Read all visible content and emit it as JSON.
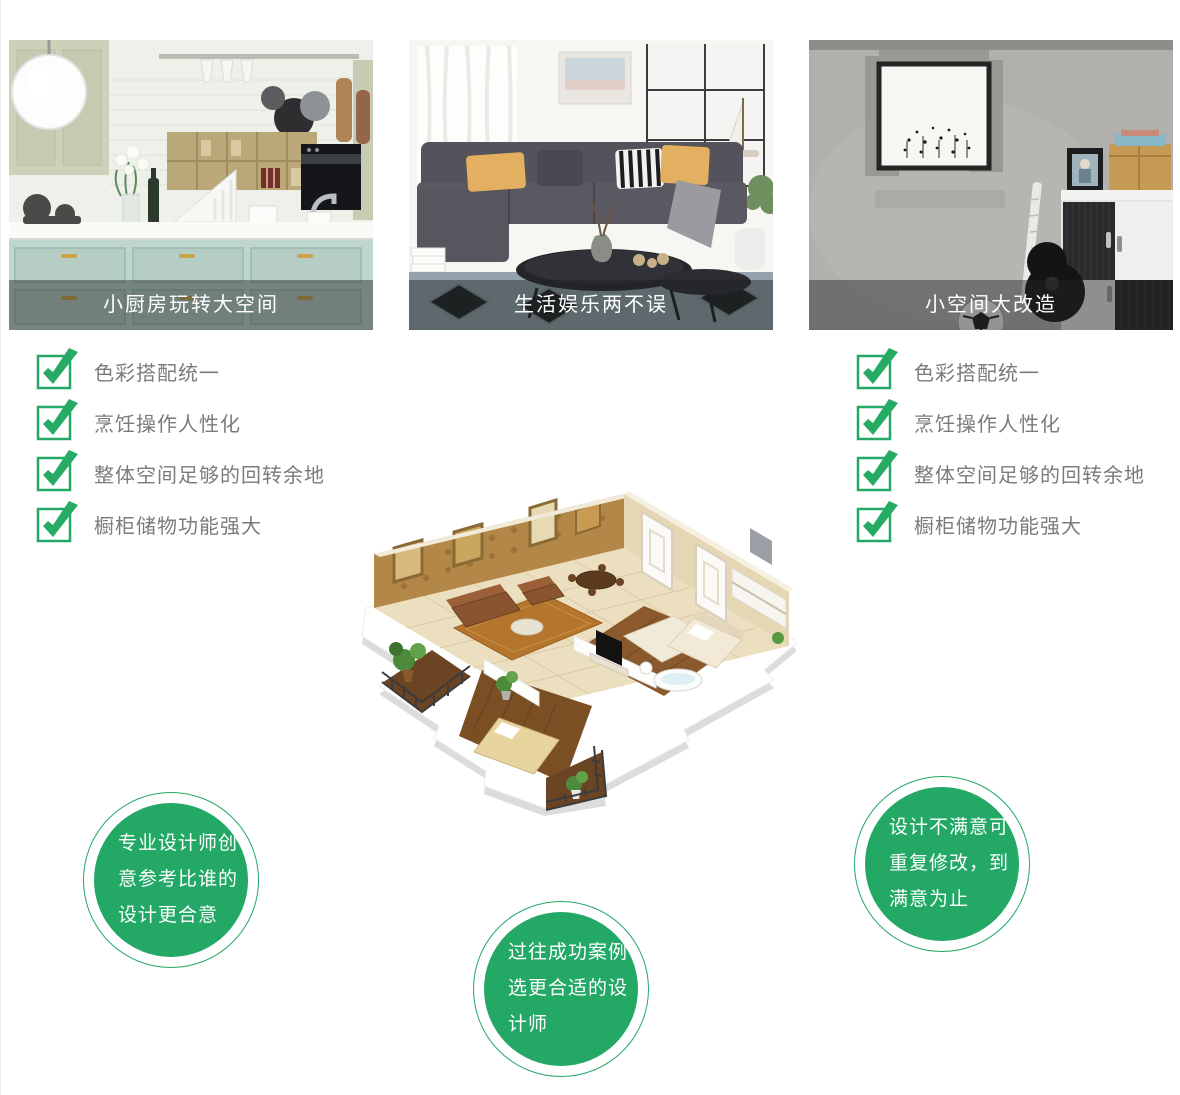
{
  "theme": {
    "green": "#23a866",
    "list_text_gray": "#7b7b7b",
    "caption_overlay": "rgba(30,36,36,0.45)",
    "caption_text": "#ffffff"
  },
  "icons": {
    "check": "checkbox-check-icon",
    "kitchen_photo": "kitchen-photo-illustration",
    "living_room_photo": "living-room-photo-illustration",
    "small_space_photo": "small-space-photo-illustration",
    "floorplan": "isometric-apartment-floorplan-illustration"
  },
  "cards": [
    {
      "caption": "小厨房玩转大空间"
    },
    {
      "caption": "生活娱乐两不误"
    },
    {
      "caption": "小空间大改造"
    }
  ],
  "checklist_left": {
    "items": [
      "色彩搭配统一",
      "烹饪操作人性化",
      "整体空间足够的回转余地",
      "橱柜储物功能强大"
    ]
  },
  "checklist_right": {
    "items": [
      "色彩搭配统一",
      "烹饪操作人性化",
      "整体空间足够的回转余地",
      "橱柜储物功能强大"
    ]
  },
  "badges": {
    "left": {
      "lines": [
        "专业设计师创",
        "意参考比谁的",
        "设计更合意"
      ]
    },
    "center": {
      "lines": [
        "过往成功案例",
        "选更合适的设",
        "计师"
      ]
    },
    "right": {
      "lines": [
        "设计不满意可",
        "重复修改，到",
        "满意为止"
      ]
    }
  }
}
